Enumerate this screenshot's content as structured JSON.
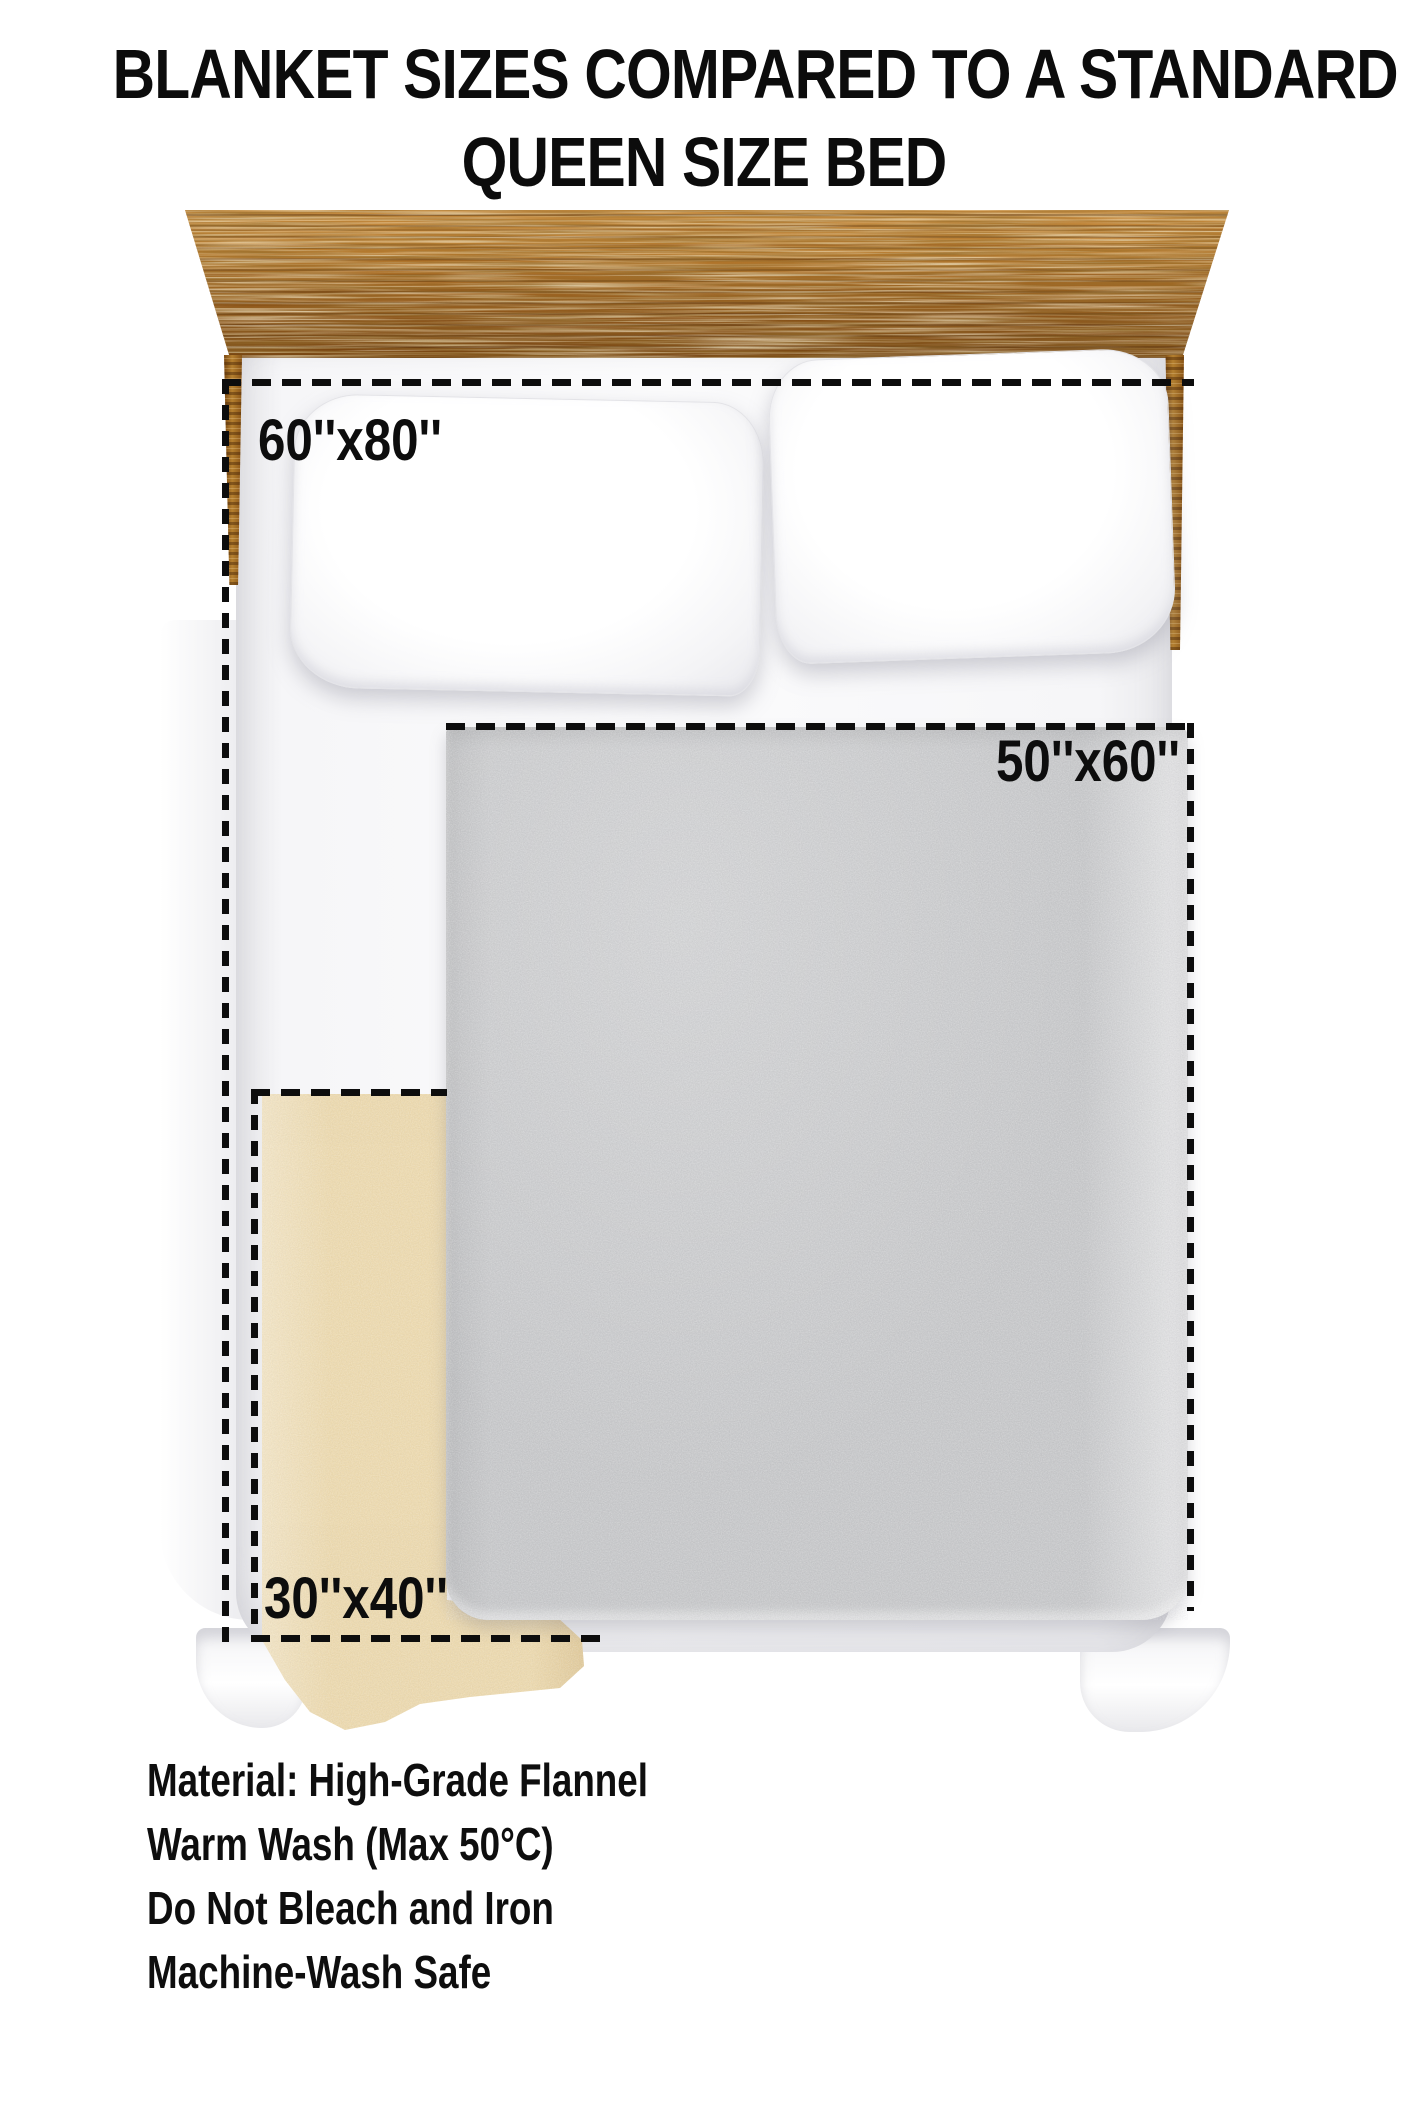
{
  "title": {
    "line1": "BLANKET SIZES COMPARED TO A STANDARD",
    "line2": "QUEEN SIZE BED"
  },
  "bed": {
    "type_label": "queen size bed",
    "parts": [
      "headboard",
      "mattress",
      "pillow-left",
      "pillow-right"
    ]
  },
  "blankets": {
    "queen_outline_size": "60''x80''",
    "medium_blanket_size": "50''x60''",
    "small_blanket_size": "30''x40''"
  },
  "care": {
    "lines": [
      "Material: High-Grade Flannel",
      "Warm Wash (Max 50°C)",
      "Do Not Bleach and Iron",
      "Machine-Wash Safe"
    ]
  },
  "colors": {
    "background": "#ffffff",
    "text": "#0d0d0d",
    "dashed_line": "#0d0d0d",
    "gray_blanket": "#c6c7c9",
    "beige_blanket": "#ecd9ae",
    "wood_light": "#c98e42",
    "wood_dark": "#774612",
    "sheet_white": "#f6f6f8"
  }
}
